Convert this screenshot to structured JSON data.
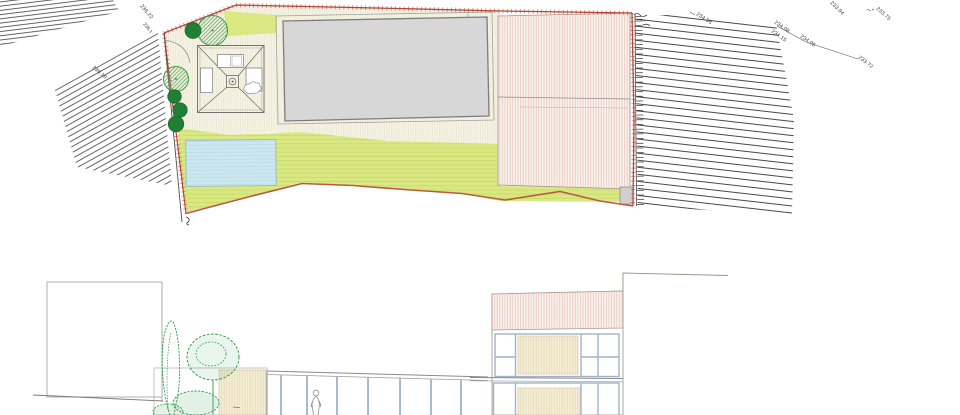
{
  "drawing": {
    "title": "site-plan-and-elevation",
    "views": {
      "top": "site plan",
      "bottom": "street elevation"
    }
  },
  "site_plan": {
    "spot_elevations": [
      {
        "name": "spot-236-22",
        "value": "236.22"
      },
      {
        "name": "spot-236-19",
        "value": "236.19"
      },
      {
        "name": "spot-236-1-red",
        "value": "236.1"
      },
      {
        "name": "spot-234-38",
        "value": "234.38"
      },
      {
        "name": "spot-234-08",
        "value": "234.08"
      },
      {
        "name": "spot-234-15",
        "value": "234.15"
      },
      {
        "name": "spot-234-05",
        "value": "234.05"
      },
      {
        "name": "spot-233-94",
        "value": "233.94"
      },
      {
        "name": "spot-233-75",
        "value": "233.75"
      },
      {
        "name": "spot-233-72",
        "value": "233.72"
      }
    ]
  },
  "colors": {
    "boundary_red": "#b5443a",
    "boundary_orange": "#bc5a40",
    "spot_label_red": "#c0564a",
    "lawn_green": "#d9e883",
    "pool_blue": "#cde7f0",
    "terrace_cream": "#f6f3e4",
    "roof_grey": "#d7d7d7",
    "neighbor_roof_pink": "#faf3ee",
    "tree_green": "#3f9a44",
    "bush_green": "#217f35",
    "elevation_tree_green": "#2f9e4a",
    "mullion_blue": "#9fb3c9",
    "panel_tan": "#f4edd6",
    "hatch_line_dark": "#3c3c3c"
  }
}
